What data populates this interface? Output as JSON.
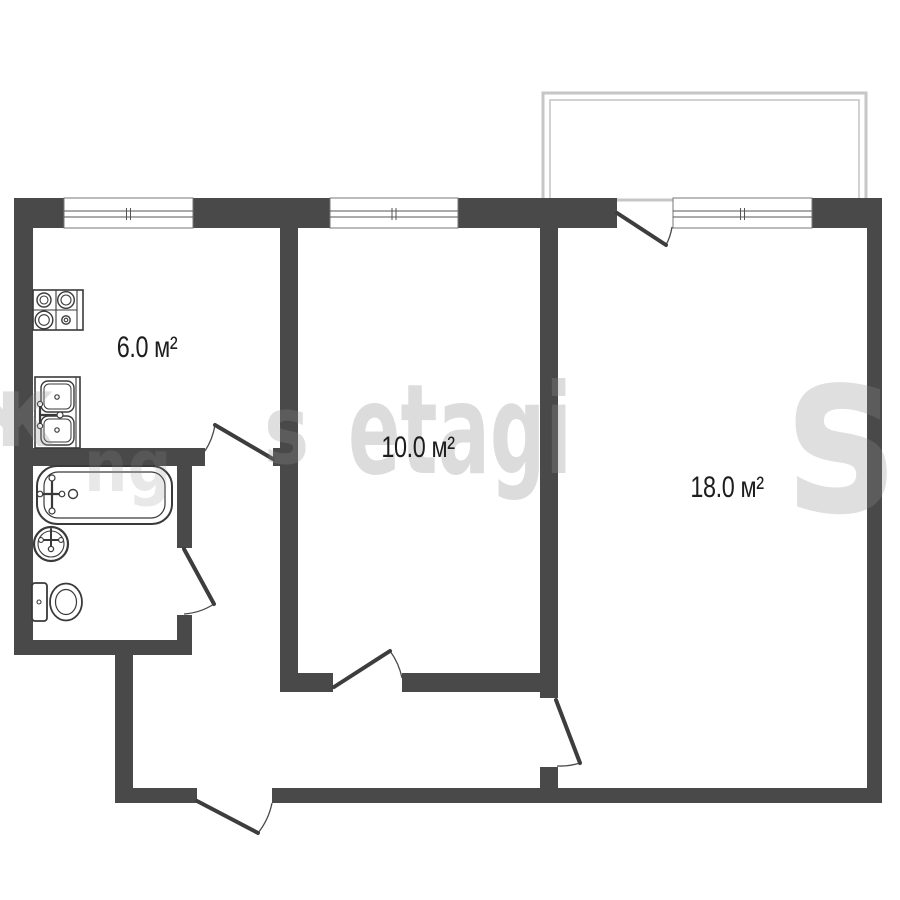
{
  "plan": {
    "colors": {
      "wall": "#494949",
      "fixture": "#3a3a3a",
      "door": "#3d3d3d",
      "door_arc": "#4a4a4a",
      "window_frame": "#777777",
      "glass": "#555555",
      "balcony": "#c6c6c6",
      "label": "#1d1d1d",
      "background": "#ffffff",
      "watermark": "#8f8f8f"
    },
    "rooms": [
      {
        "name": "kitchen",
        "area_label": "6.0 м²",
        "label_x": 147,
        "label_y": 348
      },
      {
        "name": "room-10",
        "area_label": "10.0 м²",
        "label_x": 418,
        "label_y": 448
      },
      {
        "name": "room-18",
        "area_label": "18.0 м²",
        "label_x": 727,
        "label_y": 488
      }
    ],
    "balcony": {
      "outer": {
        "x": 543,
        "y": 93,
        "w": 323,
        "h": 107
      },
      "inner": {
        "x": 550,
        "y": 100,
        "w": 309,
        "h": 100
      }
    },
    "walls": [
      {
        "name": "top-wall-seg-1",
        "x": 14,
        "y": 198,
        "w": 50,
        "h": 30
      },
      {
        "name": "top-wall-seg-2",
        "x": 193,
        "y": 198,
        "w": 137,
        "h": 30
      },
      {
        "name": "top-wall-seg-3",
        "x": 458,
        "y": 198,
        "w": 159,
        "h": 30
      },
      {
        "name": "top-wall-seg-4",
        "x": 812,
        "y": 198,
        "w": 70,
        "h": 30
      },
      {
        "name": "left-outer-wall",
        "x": 14,
        "y": 198,
        "w": 19,
        "h": 457
      },
      {
        "name": "right-outer-wall",
        "x": 867,
        "y": 198,
        "w": 15,
        "h": 605
      },
      {
        "name": "bottom-wall-left",
        "x": 115,
        "y": 788,
        "w": 82,
        "h": 15
      },
      {
        "name": "bottom-wall-right",
        "x": 272,
        "y": 788,
        "w": 610,
        "h": 15
      },
      {
        "name": "hall-left-wall",
        "x": 115,
        "y": 655,
        "w": 18,
        "h": 133
      },
      {
        "name": "bath-bottom-wall",
        "x": 14,
        "y": 640,
        "w": 178,
        "h": 15
      },
      {
        "name": "kitchen-bath-wall",
        "x": 14,
        "y": 448,
        "w": 191,
        "h": 18
      },
      {
        "name": "kitchen-bath-wall-stub",
        "x": 273,
        "y": 448,
        "w": 25,
        "h": 18
      },
      {
        "name": "kitchen-room10-wall",
        "x": 280,
        "y": 228,
        "w": 18,
        "h": 464
      },
      {
        "name": "bath-right-wall-upper",
        "x": 177,
        "y": 466,
        "w": 15,
        "h": 82
      },
      {
        "name": "bath-right-wall-lower",
        "x": 177,
        "y": 615,
        "w": 15,
        "h": 40
      },
      {
        "name": "room10-bottom-wall-left",
        "x": 298,
        "y": 673,
        "w": 35,
        "h": 19
      },
      {
        "name": "room10-bottom-wall-right",
        "x": 402,
        "y": 673,
        "w": 156,
        "h": 19
      },
      {
        "name": "room10-room18-wall",
        "x": 540,
        "y": 228,
        "w": 18,
        "h": 470
      },
      {
        "name": "room18-door-stub",
        "x": 540,
        "y": 767,
        "w": 18,
        "h": 21
      }
    ],
    "windows": [
      {
        "name": "kitchen-window",
        "x": 64,
        "y": 198,
        "w": 129,
        "h": 30,
        "glass_y": [
          211,
          217
        ]
      },
      {
        "name": "room10-window",
        "x": 330,
        "y": 198,
        "w": 128,
        "h": 30,
        "glass_y": [
          211,
          217
        ]
      },
      {
        "name": "balcony-window",
        "x": 673,
        "y": 198,
        "w": 139,
        "h": 30,
        "glass_y": [
          211,
          217
        ]
      }
    ],
    "doors": [
      {
        "name": "balcony-door",
        "panel": [
          617,
          213,
          666,
          245
        ],
        "arc": "M672,227 A57,57 0 0 1 666,245"
      },
      {
        "name": "kitchen-door",
        "panel": [
          273,
          459,
          215,
          425
        ],
        "arc": "M205,451 A68,68 0 0 0 215,425"
      },
      {
        "name": "bathroom-door",
        "panel": [
          184,
          549,
          214,
          604
        ],
        "arc": "M214,604 A63,63 0 0 1 184,614"
      },
      {
        "name": "room10-door",
        "panel": [
          334,
          687,
          390,
          651
        ],
        "arc": "M402,678 A68,68 0 0 0 390,651"
      },
      {
        "name": "room18-door",
        "panel": [
          556,
          700,
          580,
          763
        ],
        "arc": "M557,766 A66,66 0 0 0 580,763"
      },
      {
        "name": "entry-door",
        "panel": [
          197,
          801,
          258,
          833
        ],
        "arc": "M272,803 A70,70 0 0 1 258,833"
      }
    ],
    "fixtures": [
      {
        "name": "stove",
        "shapes": [
          {
            "t": "rect",
            "x": 33,
            "y": 290,
            "w": 50,
            "h": 40,
            "sw": 1.6
          },
          {
            "t": "line",
            "x1": 56,
            "y1": 290,
            "x2": 56,
            "y2": 330,
            "sw": 1.1
          },
          {
            "t": "line",
            "x1": 33,
            "y1": 310,
            "x2": 77,
            "y2": 310,
            "sw": 1.1
          },
          {
            "t": "line",
            "x1": 77,
            "y1": 290,
            "x2": 77,
            "y2": 330,
            "sw": 1.1
          },
          {
            "t": "circle",
            "cx": 44,
            "cy": 300,
            "r": 7,
            "sw": 1.4
          },
          {
            "t": "circle",
            "cx": 44,
            "cy": 300,
            "r": 4,
            "sw": 1.1
          },
          {
            "t": "circle",
            "cx": 66,
            "cy": 300,
            "r": 8.3,
            "sw": 1.4
          },
          {
            "t": "circle",
            "cx": 66,
            "cy": 300,
            "r": 5,
            "sw": 1.1
          },
          {
            "t": "circle",
            "cx": 44,
            "cy": 320,
            "r": 8.8,
            "sw": 1.4
          },
          {
            "t": "circle",
            "cx": 44,
            "cy": 320,
            "r": 5.3,
            "sw": 1.1
          },
          {
            "t": "circle",
            "cx": 66,
            "cy": 320,
            "r": 4.2,
            "sw": 1.4
          },
          {
            "t": "circle",
            "cx": 66,
            "cy": 320,
            "r": 1.8,
            "sw": 1.1
          }
        ]
      },
      {
        "name": "kitchen-sink",
        "shapes": [
          {
            "t": "rect",
            "x": 35,
            "y": 377,
            "w": 45,
            "h": 71,
            "sw": 1.6
          },
          {
            "t": "line",
            "x1": 76,
            "y1": 377,
            "x2": 76,
            "y2": 448,
            "sw": 1.1
          },
          {
            "t": "rect",
            "x": 41,
            "y": 381,
            "w": 33,
            "h": 31,
            "rx": 7,
            "sw": 1.4
          },
          {
            "t": "rect",
            "x": 44,
            "y": 384,
            "w": 27,
            "h": 25,
            "rx": 5,
            "sw": 1
          },
          {
            "t": "circle",
            "cx": 57,
            "cy": 397,
            "r": 2.2,
            "sw": 1.2
          },
          {
            "t": "rect",
            "x": 41,
            "y": 416,
            "w": 33,
            "h": 29,
            "rx": 7,
            "sw": 1.4
          },
          {
            "t": "rect",
            "x": 44,
            "y": 419,
            "w": 27,
            "h": 23,
            "rx": 5,
            "sw": 1
          },
          {
            "t": "circle",
            "cx": 57,
            "cy": 430,
            "r": 2.2,
            "sw": 1.2
          },
          {
            "t": "line",
            "x1": 40,
            "y1": 406,
            "x2": 40,
            "y2": 424,
            "sw": 2.2
          },
          {
            "t": "circle",
            "cx": 40,
            "cy": 404,
            "r": 2.6,
            "sw": 1.2,
            "fill": "#fff"
          },
          {
            "t": "circle",
            "cx": 40,
            "cy": 426,
            "r": 2.6,
            "sw": 1.2,
            "fill": "#fff"
          },
          {
            "t": "line",
            "x1": 40,
            "y1": 415,
            "x2": 59,
            "y2": 415,
            "sw": 2.2
          },
          {
            "t": "circle",
            "cx": 60,
            "cy": 415,
            "r": 3,
            "sw": 1.2,
            "fill": "#fff"
          }
        ]
      },
      {
        "name": "bathtub",
        "shapes": [
          {
            "t": "rect",
            "x": 37,
            "y": 466,
            "w": 135,
            "h": 58,
            "rx": 20,
            "sw": 2
          },
          {
            "t": "rect",
            "x": 44,
            "y": 472,
            "w": 121,
            "h": 46,
            "rx": 14,
            "sw": 1.2
          },
          {
            "t": "line",
            "x1": 52,
            "y1": 480,
            "x2": 52,
            "y2": 509,
            "sw": 2.2
          },
          {
            "t": "circle",
            "cx": 52,
            "cy": 478,
            "r": 3,
            "sw": 1.2,
            "fill": "#fff"
          },
          {
            "t": "circle",
            "cx": 52,
            "cy": 511,
            "r": 3,
            "sw": 1.2,
            "fill": "#fff"
          },
          {
            "t": "line",
            "x1": 42,
            "y1": 494,
            "x2": 60,
            "y2": 494,
            "sw": 2.2
          },
          {
            "t": "circle",
            "cx": 40,
            "cy": 494,
            "r": 2.8,
            "sw": 1.2,
            "fill": "#fff"
          },
          {
            "t": "circle",
            "cx": 62,
            "cy": 494,
            "r": 2.8,
            "sw": 1.2,
            "fill": "#fff"
          },
          {
            "t": "circle",
            "cx": 73,
            "cy": 494,
            "r": 4.5,
            "sw": 1.4,
            "fill": "#fff"
          }
        ]
      },
      {
        "name": "wash-basin",
        "shapes": [
          {
            "t": "circle",
            "cx": 51,
            "cy": 544,
            "r": 17,
            "sw": 2.2
          },
          {
            "t": "circle",
            "cx": 51,
            "cy": 544,
            "r": 13,
            "sw": 1.1
          },
          {
            "t": "line",
            "x1": 51,
            "y1": 529,
            "x2": 51,
            "y2": 551,
            "sw": 2
          },
          {
            "t": "line",
            "x1": 42,
            "y1": 540,
            "x2": 60,
            "y2": 540,
            "sw": 2
          },
          {
            "t": "circle",
            "cx": 41,
            "cy": 540,
            "r": 2.4,
            "sw": 1.1,
            "fill": "#fff"
          },
          {
            "t": "circle",
            "cx": 61,
            "cy": 540,
            "r": 2.4,
            "sw": 1.1,
            "fill": "#fff"
          },
          {
            "t": "circle",
            "cx": 51,
            "cy": 549,
            "r": 2.6,
            "sw": 1.3,
            "fill": "#fff"
          }
        ]
      },
      {
        "name": "toilet",
        "shapes": [
          {
            "t": "rect",
            "x": 32,
            "y": 583,
            "w": 15,
            "h": 38,
            "rx": 3,
            "sw": 1.8
          },
          {
            "t": "circle",
            "cx": 39,
            "cy": 602,
            "r": 2,
            "sw": 1.1
          },
          {
            "t": "ellipse",
            "cx": 66,
            "cy": 602,
            "rx": 16,
            "ry": 18.5,
            "sw": 1.8
          },
          {
            "t": "ellipse",
            "cx": 66,
            "cy": 602,
            "rx": 10.5,
            "ry": 12.5,
            "sw": 1.2
          }
        ]
      }
    ]
  },
  "watermark": {
    "fragments": [
      {
        "text": "ж",
        "x": -34,
        "y": 362,
        "size": 100,
        "scale_x": 0.9,
        "opacity": 0.28
      },
      {
        "text": "ng",
        "x": 84,
        "y": 430,
        "size": 72,
        "scale_x": 0.85,
        "opacity": 0.2
      },
      {
        "text": "s",
        "x": 264,
        "y": 384,
        "size": 95,
        "scale_x": 0.8,
        "opacity": 0.28
      },
      {
        "text": "etagi",
        "x": 348,
        "y": 368,
        "size": 125,
        "scale_x": 0.62,
        "opacity": 0.3
      },
      {
        "text": "s",
        "x": 786,
        "y": 318,
        "size": 230,
        "scale_x": 0.8,
        "opacity": 0.28
      }
    ]
  }
}
